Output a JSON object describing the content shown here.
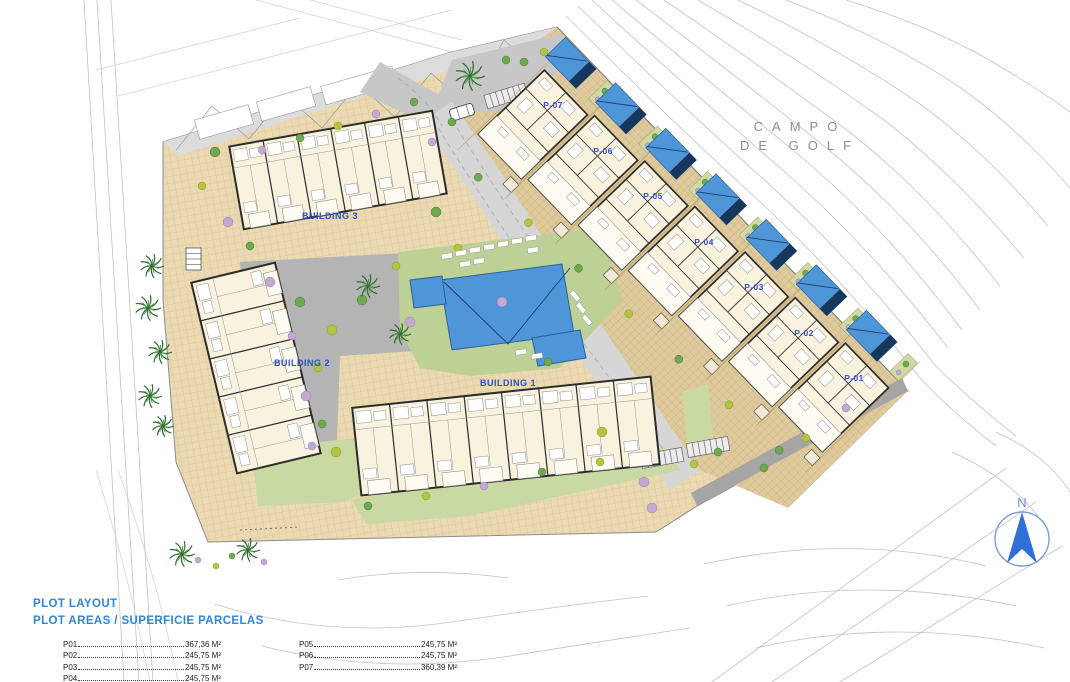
{
  "golf": {
    "line1": "CAMPO",
    "line2": "DE GOLF"
  },
  "buildings": [
    {
      "label": "BUILDING 3"
    },
    {
      "label": "BUILDING 2"
    },
    {
      "label": "BUILDING 1"
    }
  ],
  "plots": [
    {
      "label": "P-07"
    },
    {
      "label": "P-06"
    },
    {
      "label": "P-05"
    },
    {
      "label": "P-04"
    },
    {
      "label": "P-03"
    },
    {
      "label": "P-02"
    },
    {
      "label": "P-01"
    }
  ],
  "north": {
    "label": "N"
  },
  "legend": {
    "title": "PLOT LAYOUT",
    "subtitle": "PLOT AREAS / SUPERFICIE PARCELAS",
    "entries": [
      {
        "name": "P01",
        "area": "367,36 M²"
      },
      {
        "name": "P02",
        "area": "245,75 M²"
      },
      {
        "name": "P03",
        "area": "245,75 M²"
      },
      {
        "name": "P04",
        "area": "245,75 M²"
      },
      {
        "name": "P05",
        "area": "245,75 M²"
      },
      {
        "name": "P06",
        "area": "245,75 M²"
      },
      {
        "name": "P07",
        "area": "360,39 M²"
      }
    ]
  },
  "colors": {
    "label_blue": "#2f4fc5",
    "legend_blue": "#2e86d6",
    "pool_blue": "#4f96d8",
    "pool_dark": "#16365c",
    "north_blue": "#2e6fd8",
    "paving_tan": "#ead9b1",
    "lawn_green": "#c9d9a3",
    "road_gray": "#d6d6d6",
    "contour_gray": "#c2c2c2"
  }
}
